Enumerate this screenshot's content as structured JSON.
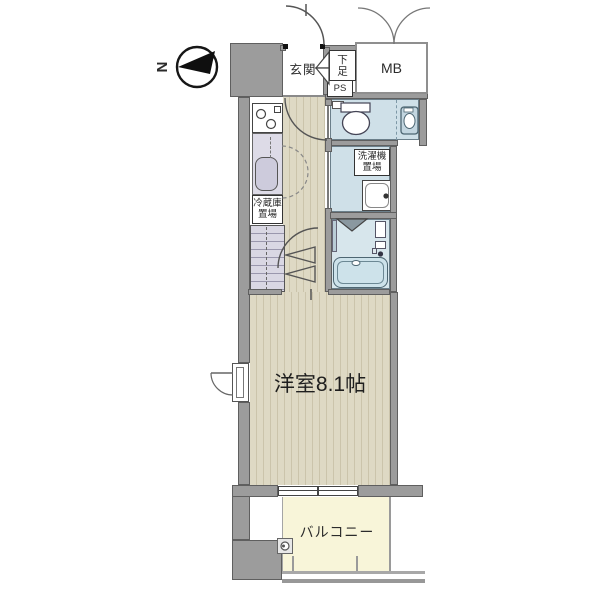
{
  "compass": {
    "north_label": "N"
  },
  "labels": {
    "entrance": "玄関",
    "shoe_cabinet": "下足",
    "pipe_space": "PS",
    "meter_box": "MB",
    "washing_machine": {
      "line1": "洗濯機",
      "line2": "置場"
    },
    "refrigerator": {
      "line1": "冷蔵庫",
      "line2": "置場"
    },
    "main_room": "洋室8.1帖",
    "balcony": "バルコニー"
  },
  "palette": {
    "wall": "#9c9c9c",
    "wall-line": "#5f5f5f",
    "floor": "#ded9c4",
    "floor-stripe": "#cbc4ab",
    "water": "#cfe0e8",
    "bath": "#d7e6ec",
    "tub": "#cde2ea",
    "fixture": "#c3d6e0",
    "balcony": "#f8f5d9",
    "closet": "#d9d7e3",
    "counter": "#dddbe7",
    "ink": "#2a2a2a"
  }
}
